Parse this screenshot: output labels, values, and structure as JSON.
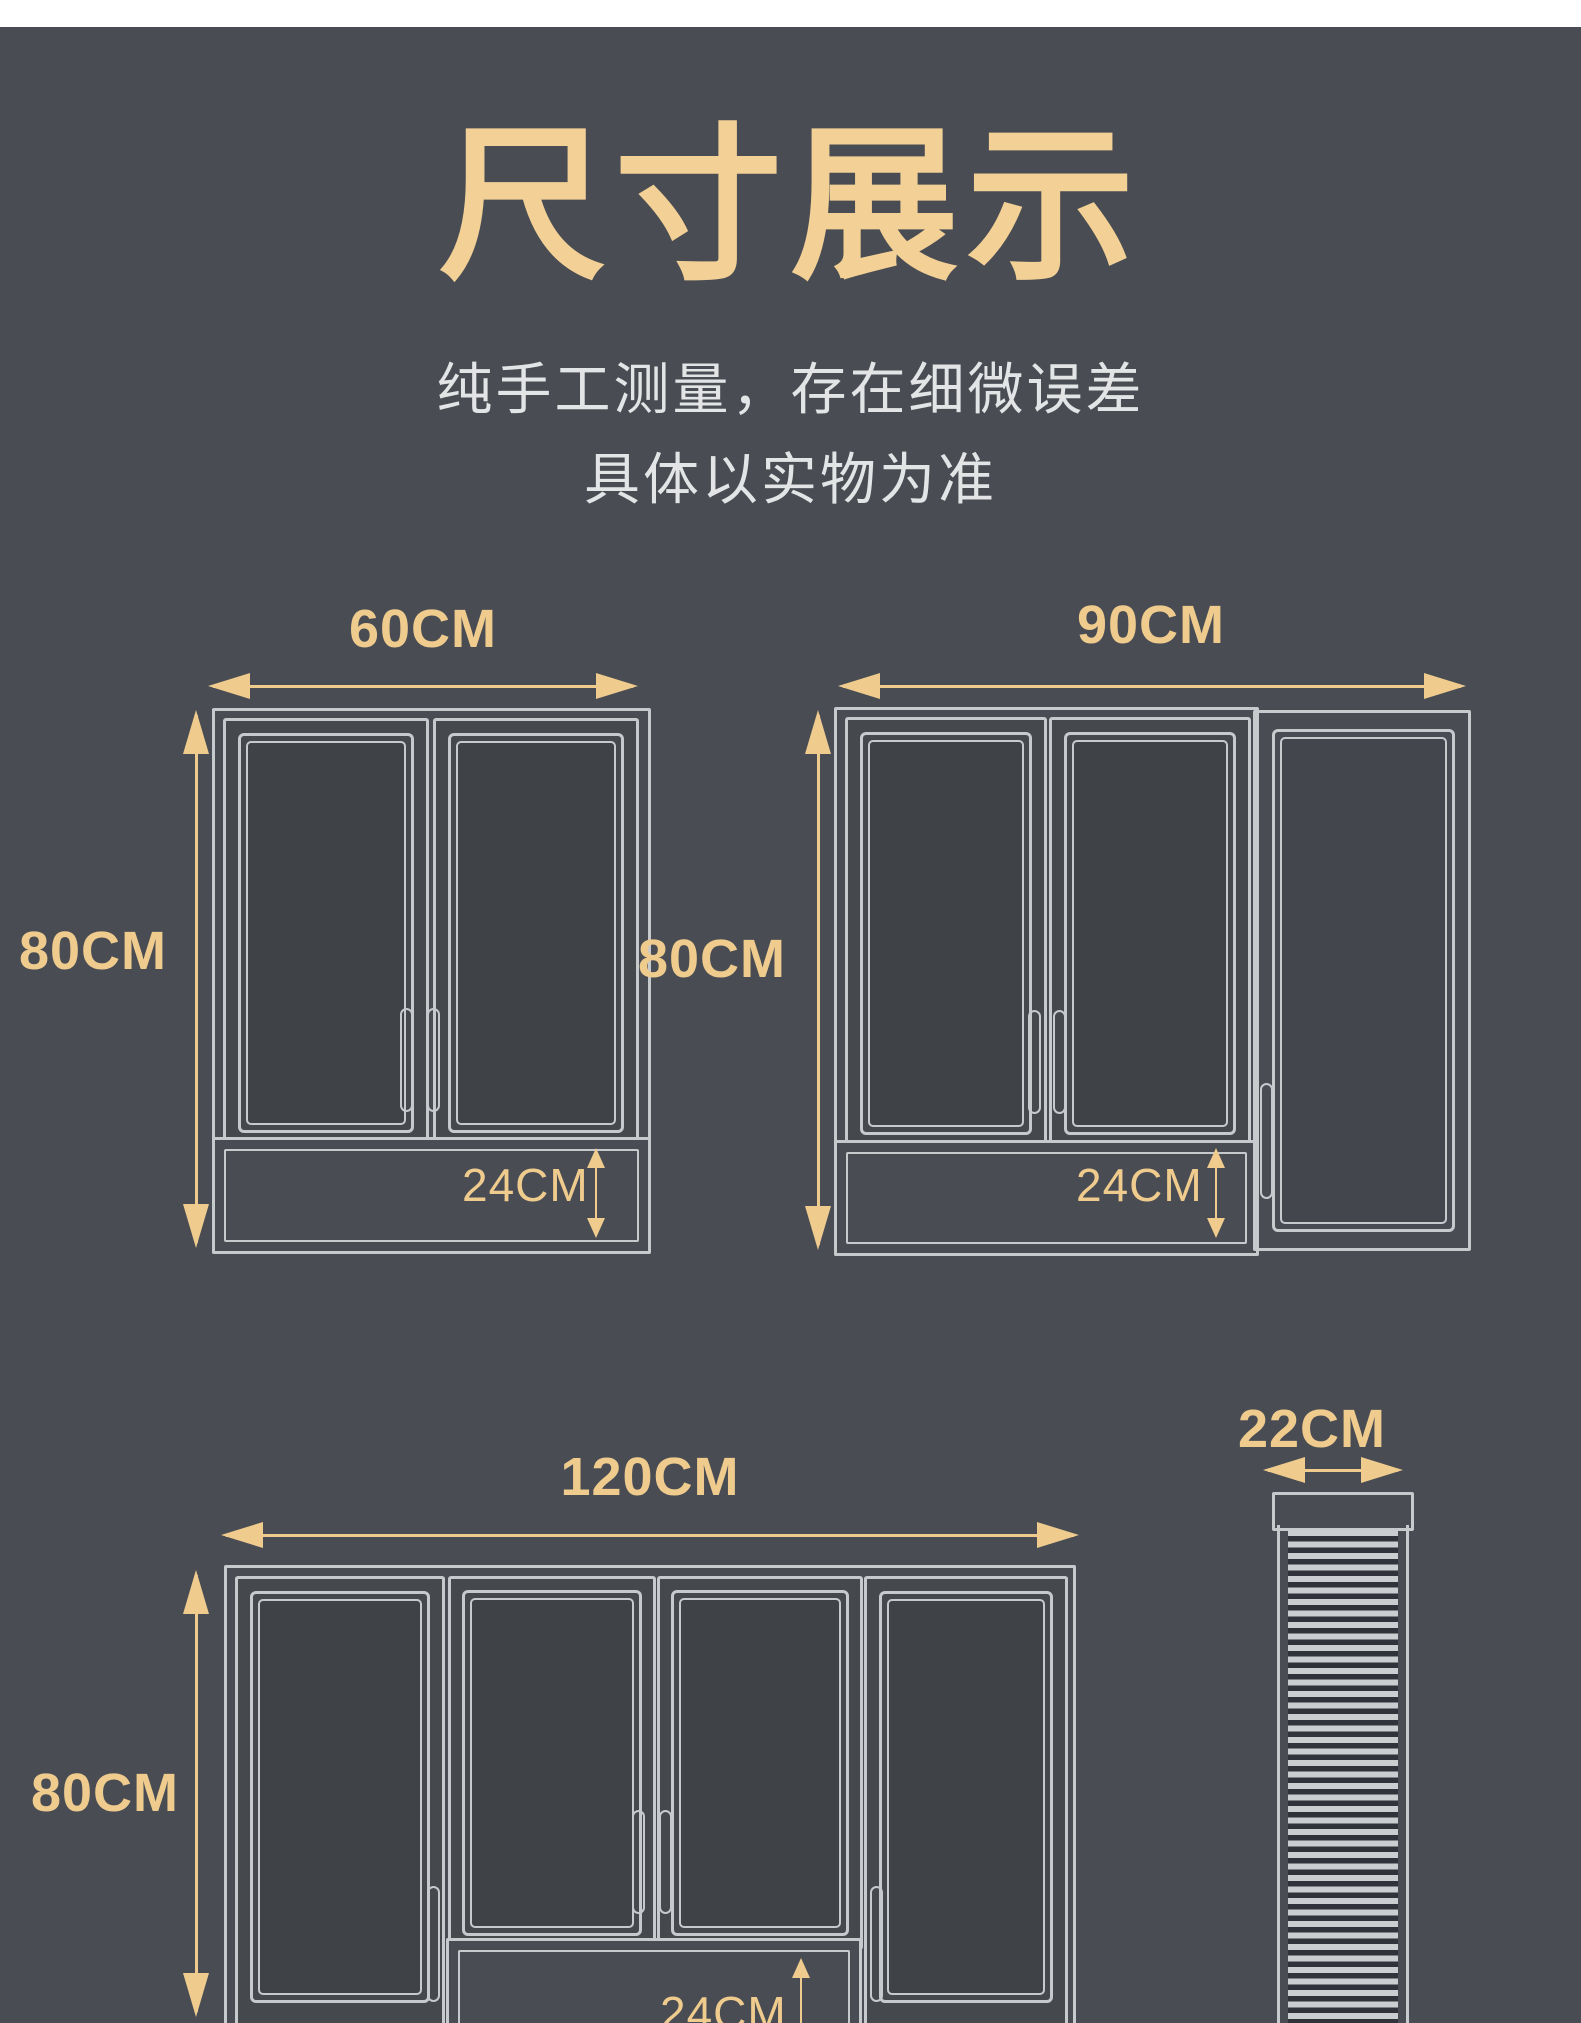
{
  "palette": {
    "background": "#494d53",
    "accent_gold": "#efcb8e",
    "title_gold": "#f2d096",
    "line_gray": "#c7cacd",
    "subtitle_gray": "#e3e4e6",
    "top_strip": "#ffffff"
  },
  "header": {
    "title": "尺寸展示",
    "subtitle_line1": "纯手工测量，存在细微误差",
    "subtitle_line2": "具体以实物为准"
  },
  "cabinets": {
    "cab60": {
      "width_label": "60CM",
      "height_label": "80CM",
      "drawer_label": "24CM"
    },
    "cab90": {
      "width_label": "90CM",
      "height_label": "80CM",
      "drawer_label": "24CM"
    },
    "cab120": {
      "width_label": "120CM",
      "height_label": "80CM",
      "drawer_label": "24CM"
    },
    "cab22": {
      "width_label": "22CM"
    }
  }
}
